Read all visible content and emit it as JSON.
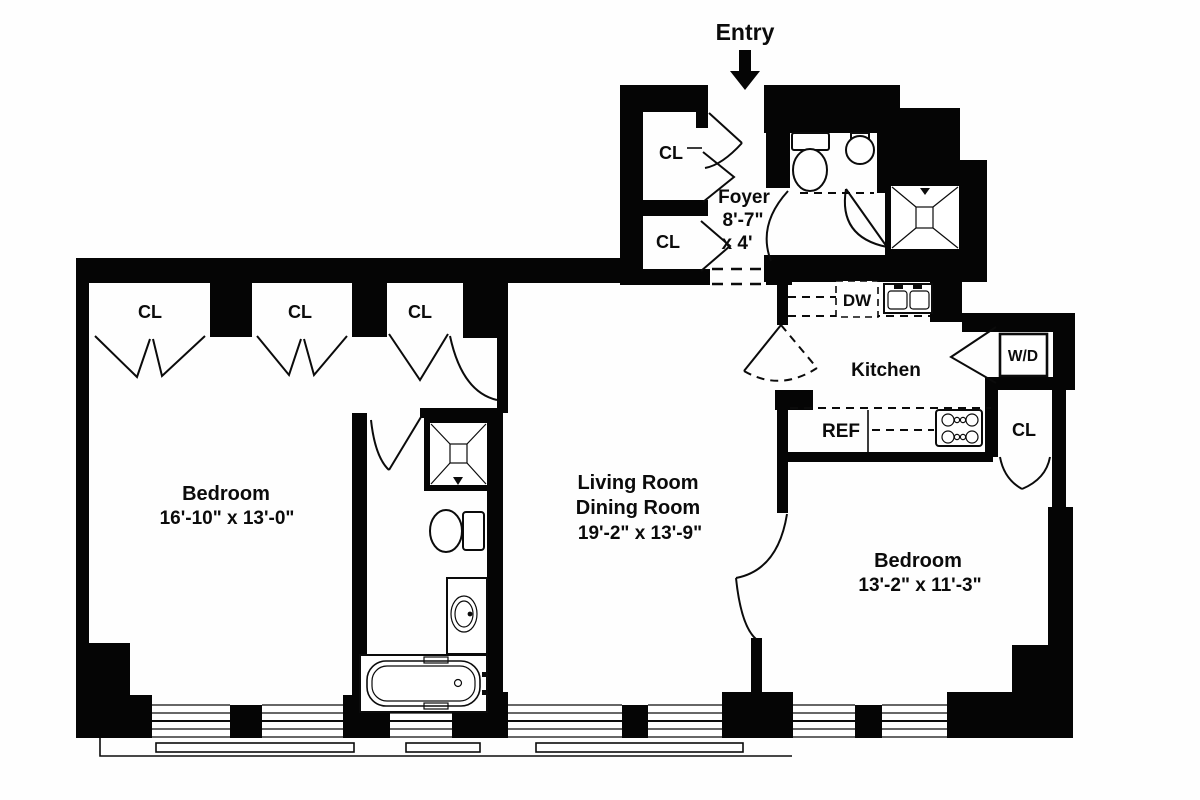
{
  "plan": {
    "entry": "Entry",
    "foyer": {
      "name": "Foyer",
      "dim1": "8'-7\"",
      "dim2": "x 4'"
    },
    "kitchen": "Kitchen",
    "appliances": {
      "dw": "DW",
      "ref": "REF",
      "wd": "W/D"
    },
    "living": {
      "name1": "Living Room",
      "name2": "Dining Room",
      "dim": "19'-2\"  x  13'-9\""
    },
    "bedroom1": {
      "name": "Bedroom",
      "dim": "16'-10\" x 13'-0\""
    },
    "bedroom2": {
      "name": "Bedroom",
      "dim": "13'-2\"  x  11'-3\""
    },
    "closets": [
      "CL",
      "CL",
      "CL",
      "CL",
      "CL",
      "CL"
    ],
    "colors": {
      "wall": "#050505",
      "background": "#ffffff"
    }
  }
}
